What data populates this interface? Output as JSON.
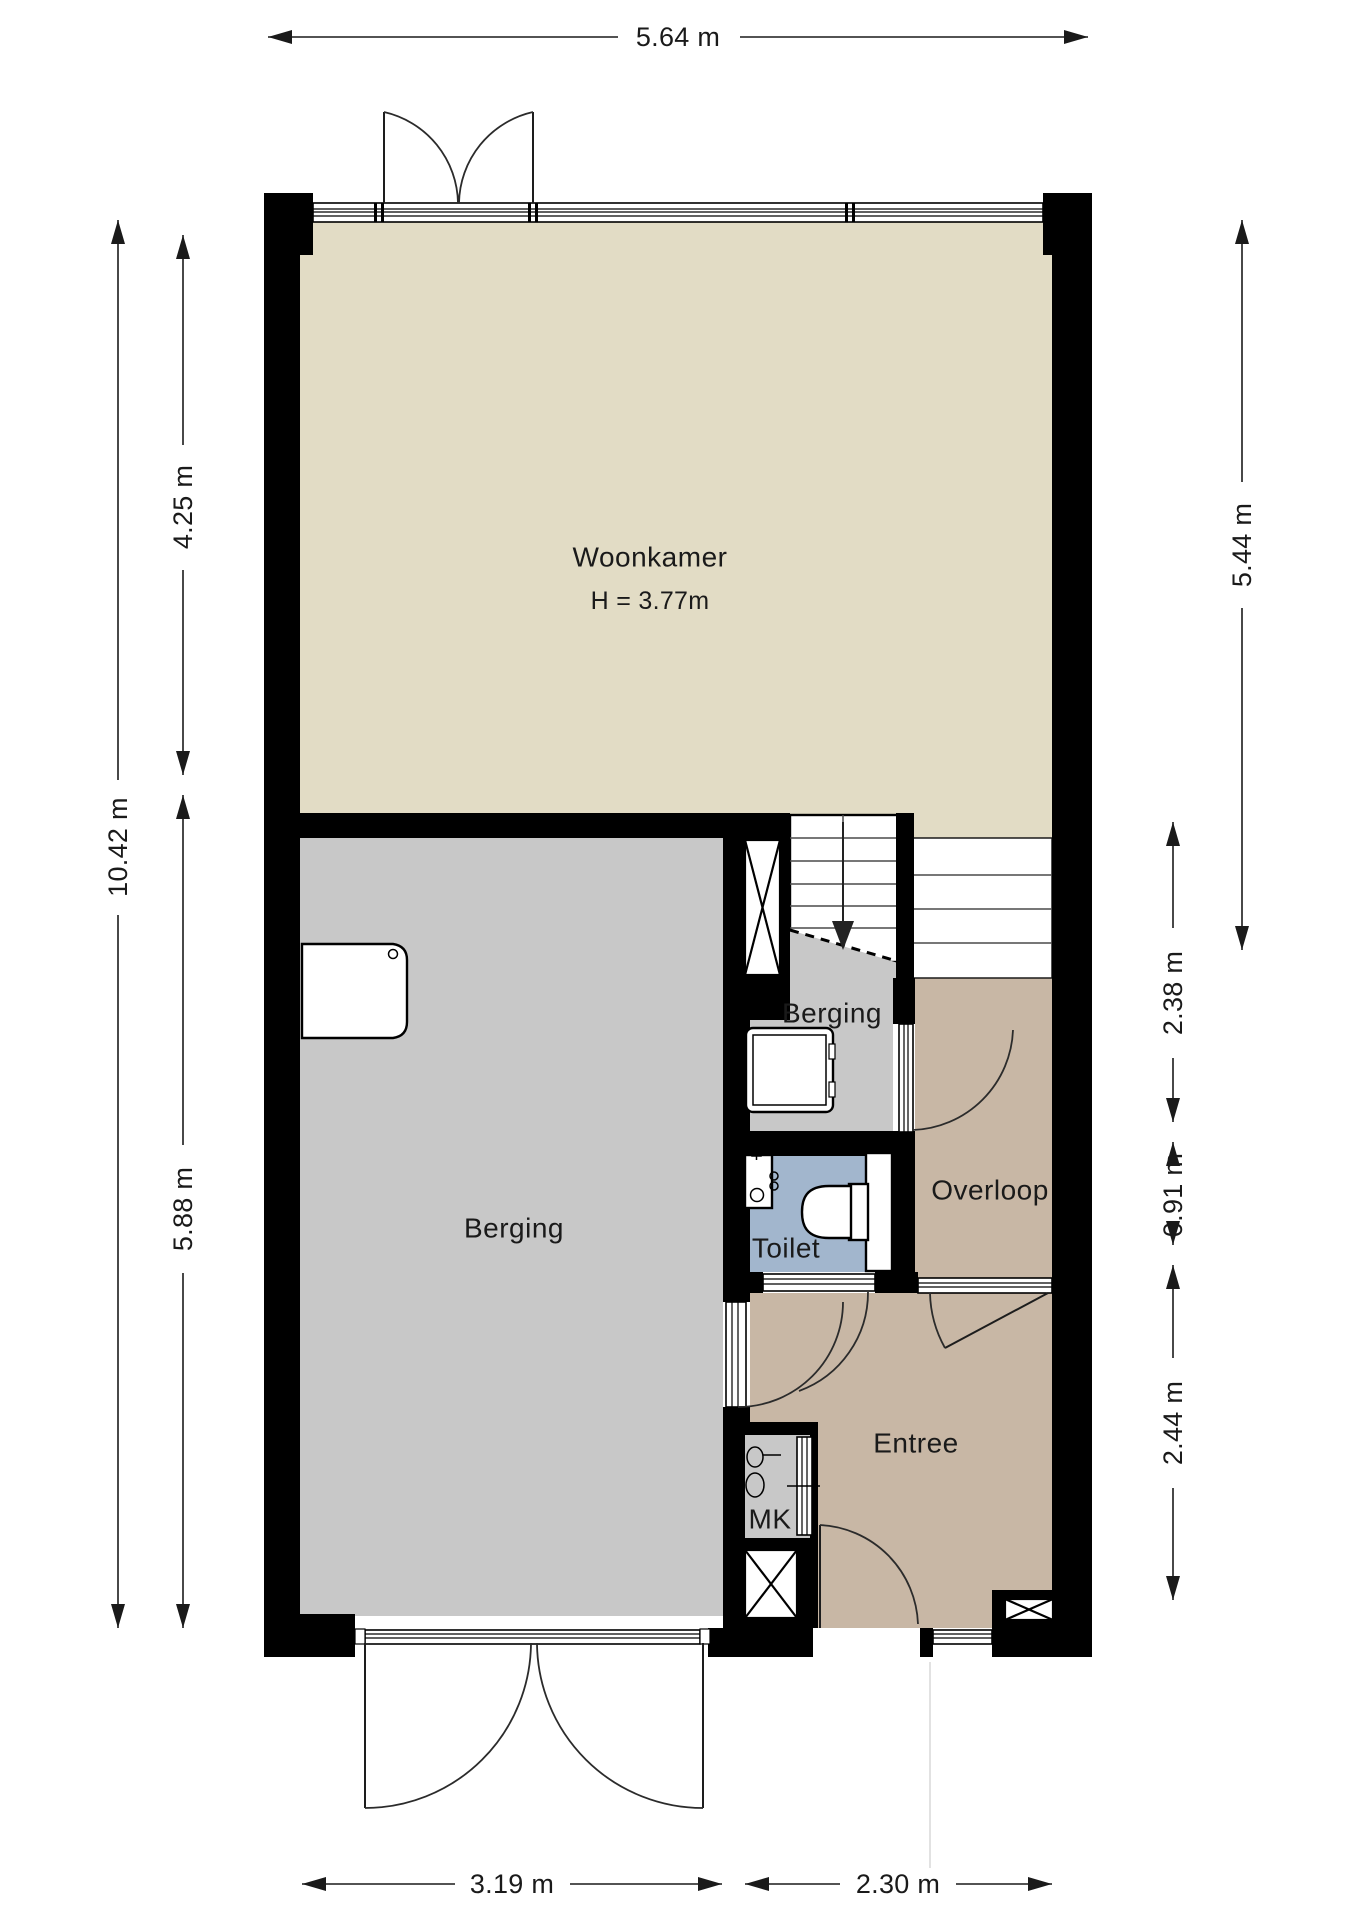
{
  "rooms": {
    "woonkamer": {
      "label": "Woonkamer",
      "height_note": "H = 3.77m"
    },
    "berging_large": {
      "label": "Berging"
    },
    "berging_small": {
      "label": "Berging"
    },
    "toilet": {
      "label": "Toilet"
    },
    "overloop": {
      "label": "Overloop"
    },
    "entree": {
      "label": "Entree"
    },
    "meterkast": {
      "label": "MK"
    }
  },
  "dimensions": {
    "top": "5.64 m",
    "left_total": "10.42 m",
    "left_upper": "4.25 m",
    "left_lower": "5.88 m",
    "right_upper": "5.44 m",
    "right_middle_upper": "2.38 m",
    "right_middle_lower": "0.91 m",
    "right_lower": "2.44 m",
    "bottom_left": "3.19 m",
    "bottom_right": "2.30 m"
  },
  "colors": {
    "background": "#FFFFFF",
    "wall": "#000000",
    "woonkamer_floor": "#E2DCC5",
    "berging_floor": "#C8C8C8",
    "hall_floor": "#C8B7A5",
    "toilet_floor": "#A2B6CD",
    "text": "#1A1A1A"
  }
}
